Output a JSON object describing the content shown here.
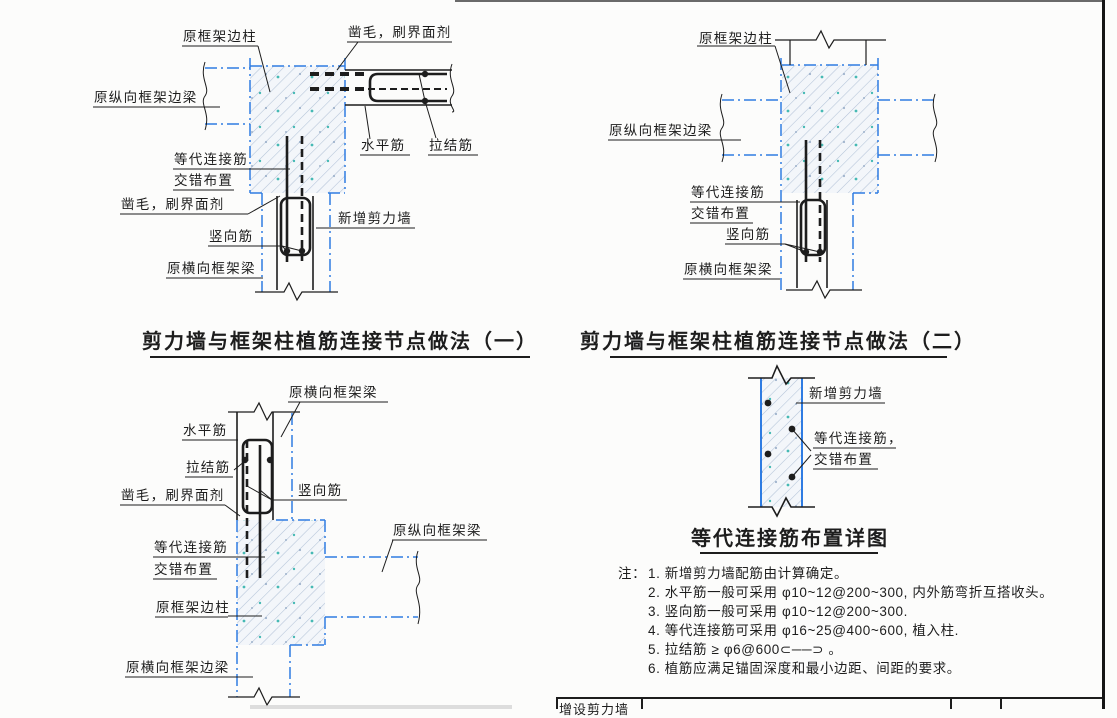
{
  "colors": {
    "blue_axis": "#2f7ce2",
    "ink": "#1d1d1d",
    "hatch_line": "#b4c3d8",
    "speckle_teal": "#46b9b4",
    "concrete_bg": "#f3f6fa"
  },
  "diagram1": {
    "title": "剪力墙与框架柱植筋连接节点做法（一）",
    "labels": {
      "column": "原框架边柱",
      "chisel_top": "凿毛，刷界面剂",
      "beam_longitudinal": "原纵向框架边梁",
      "equiv_bar_1": "等代连接筋",
      "equiv_bar_2": "交错布置",
      "chisel_left": "凿毛，刷界面剂",
      "horizontal_bar": "水平筋",
      "tie_bar": "拉结筋",
      "new_wall": "新增剪力墙",
      "vertical_bar": "竖向筋",
      "beam_transverse": "原横向框架梁"
    }
  },
  "diagram2": {
    "title": "剪力墙与框架柱植筋连接节点做法（二）",
    "labels": {
      "column": "原框架边柱",
      "beam_longitudinal": "原纵向框架边梁",
      "equiv_bar_1": "等代连接筋",
      "equiv_bar_2": "交错布置",
      "vertical_bar": "竖向筋",
      "beam_transverse": "原横向框架梁"
    }
  },
  "diagram3": {
    "labels": {
      "beam_transverse_top": "原横向框架梁",
      "horizontal_bar": "水平筋",
      "tie_bar": "拉结筋",
      "chisel": "凿毛，刷界面剂",
      "vertical_bar": "竖向筋",
      "equiv_bar_1": "等代连接筋",
      "equiv_bar_2": "交错布置",
      "column": "原框架边柱",
      "beam_longitudinal": "原纵向框架梁",
      "beam_edge_bottom": "原横向框架边梁"
    }
  },
  "diagram4": {
    "title": "等代连接筋布置详图",
    "labels": {
      "new_wall": "新增剪力墙",
      "equiv_bar_1": "等代连接筋，",
      "equiv_bar_2": "交错布置"
    }
  },
  "notes": {
    "prefix": "注：",
    "items": [
      "1. 新增剪力墙配筋由计算确定。",
      "2. 水平筋一般可采用 φ10~12@200~300, 内外筋弯折互搭收头。",
      "3. 竖向筋一般可采用 φ10~12@200~300.",
      "4. 等代连接筋可采用 φ16~25@400~600, 植入柱.",
      "5. 拉结筋 ≥ φ6@600⊂──⊃ 。",
      "6. 植筋应满足锚固深度和最小边距、间距的要求。"
    ]
  },
  "title_block": {
    "cell_1": "增设剪力墙"
  }
}
